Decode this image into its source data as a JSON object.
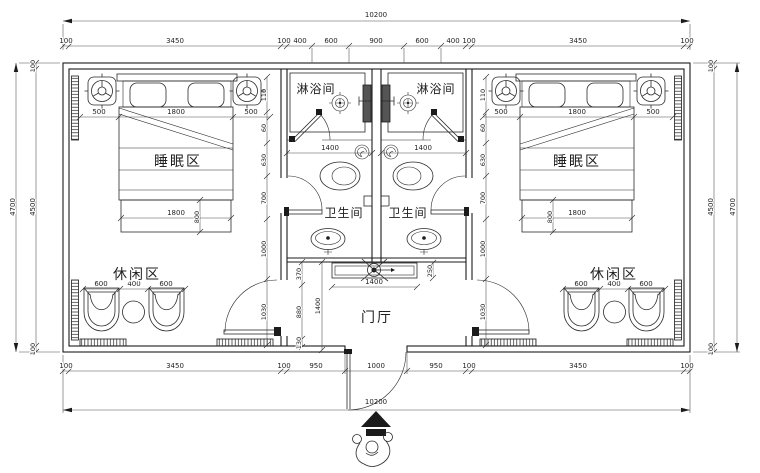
{
  "labels": {
    "shower": "淋浴间",
    "wc": "卫生间",
    "sleep": "睡眠区",
    "leisure": "休闲区",
    "hall": "门厅"
  },
  "dims": {
    "overall_h": "10200",
    "top": [
      "100",
      "3450",
      "100",
      "400",
      "600",
      "900",
      "600",
      "400",
      "100",
      "3450",
      "100"
    ],
    "bottom": [
      "100",
      "3450",
      "100",
      "950",
      "1000",
      "950",
      "100",
      "3450",
      "100"
    ],
    "side_outer": "4700",
    "side_chain": [
      "100",
      "4500",
      "100"
    ],
    "bed_top": [
      "500",
      "1800",
      "500"
    ],
    "bed_width": "1800",
    "bed_depth": "800",
    "leisure_chain": [
      "600",
      "400",
      "600"
    ],
    "shower_width": "1400",
    "counter_width": "1400",
    "counter_depth": "250",
    "hall_height": "1400",
    "hall_chain": [
      "370",
      "880",
      "130"
    ],
    "room_side_chain": [
      "110",
      "60",
      "630",
      "700",
      "1000",
      "1030"
    ]
  }
}
